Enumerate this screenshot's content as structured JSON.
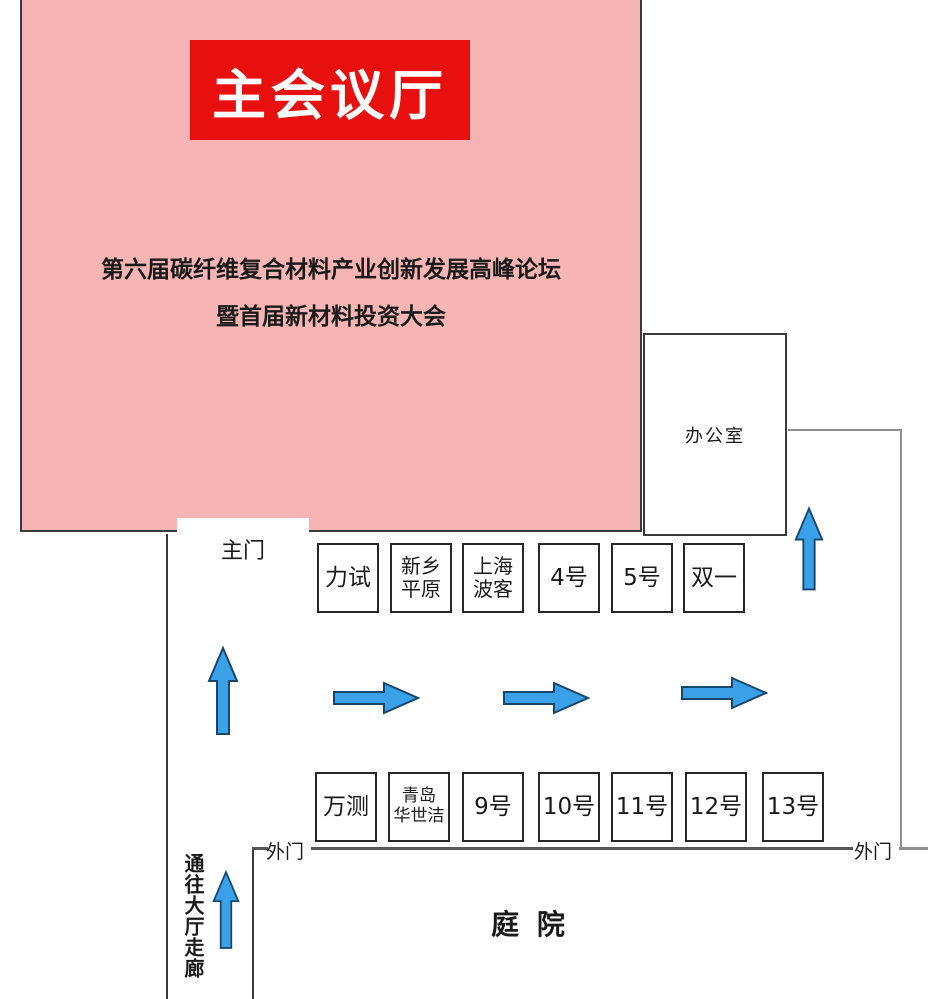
{
  "venue": {
    "hall": {
      "title": "主会议厅",
      "subtitle_line1": "第六届碳纤维复合材料产业创新发展高峰论坛",
      "subtitle_line2": "暨首届新材料投资大会"
    },
    "office_label": "办公室",
    "main_door_label": "主门",
    "outer_door_left_label": "外门",
    "outer_door_right_label": "外门",
    "corridor_label": "通往大厅走廊",
    "courtyard_label": "庭 院"
  },
  "booths": {
    "top_row": [
      {
        "label": "力试"
      },
      {
        "label": "新乡\n平原"
      },
      {
        "label": "上海\n波客"
      },
      {
        "label": "4号"
      },
      {
        "label": "5号"
      },
      {
        "label": "双一"
      }
    ],
    "bottom_row": [
      {
        "label": "万测"
      },
      {
        "label": "青岛\n华世洁"
      },
      {
        "label": "9号"
      },
      {
        "label": "10号"
      },
      {
        "label": "11号"
      },
      {
        "label": "12号"
      },
      {
        "label": "13号"
      }
    ]
  },
  "icons": {
    "up_arrow": "up-arrow-icon",
    "right_arrow": "right-arrow-icon"
  },
  "colors": {
    "hall_pink": "#f6b4b4",
    "banner_red": "#e8100e",
    "arrow_blue": "#3aa0e8",
    "arrow_outline": "#17476f",
    "wall_dark": "#3a3a3a",
    "wall_gray": "#8f8f8f"
  }
}
